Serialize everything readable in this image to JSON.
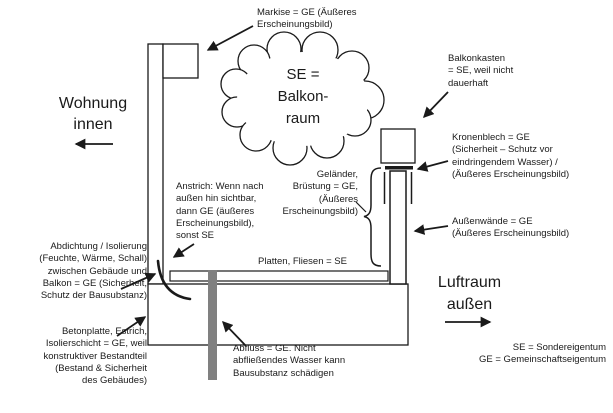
{
  "labels": {
    "markise": "Markise = GE (Äußeres\nErscheinungsbild)",
    "cloud": "SE =\nBalkon-\nraum",
    "balkonkasten": "Balkonkasten\n= SE, weil nicht\ndauerhaft",
    "kronenblech": "Kronenblech = GE\n(Sicherheit – Schutz vor\neindringendem Wasser) /\n(Äußeres Erscheinungsbild)",
    "gelaender": "Geländer,\nBrüstung = GE,\n(Äußeres\nErscheinungsbild)",
    "aussenwaende": "Außenwände = GE\n(Äußeres Erscheinungsbild)",
    "wohnung": "Wohnung\ninnen",
    "anstrich": "Anstrich: Wenn nach\naußen hin sichtbar,\ndann GE (äußeres\nErscheinungsbild),\nsonst SE",
    "abdichtung": "Abdichtung / Isolierung\n(Feuchte, Wärme, Schall)\nzwischen Gebäude und\nBalkon = GE (Sicherheit,\nSchutz der Bausubstanz)",
    "betonplatte": "Betonplatte, Estrich,\nIsolierschicht = GE, weil\nkonstruktiver Bestandteil\n(Bestand & Sicherheit\ndes Gebäudes)",
    "platten": "Platten, Fliesen = SE",
    "abfluss": "Abfluss = GE. Nicht\nabfließendes Wasser kann\nBausubstanz schädigen",
    "luftraum": "Luftraum\naußen",
    "legend": "SE = Sondereigentum\nGE = Gemeinschaftseigentum"
  },
  "colors": {
    "line": "#1a1a1a",
    "pipe": "#808080",
    "background": "#ffffff"
  }
}
